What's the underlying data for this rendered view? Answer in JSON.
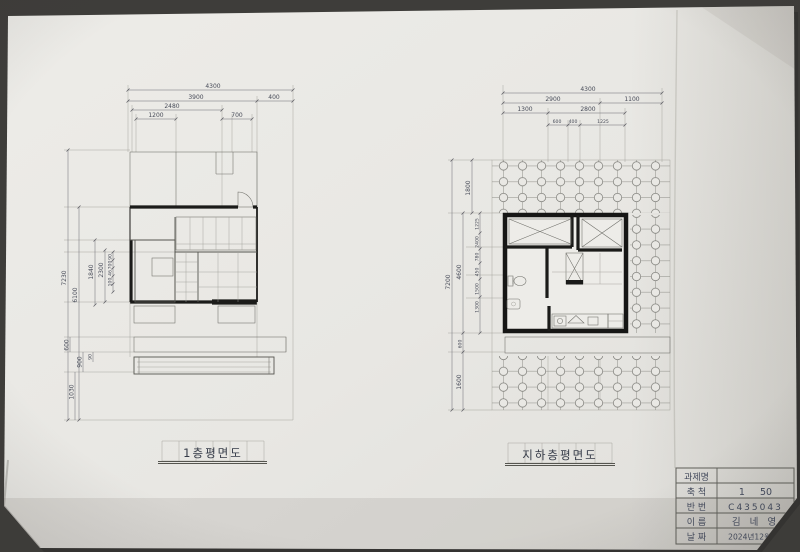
{
  "left_plan": {
    "caption": "1층평면도",
    "top_dims": [
      "4300",
      "3900",
      "400",
      "2480",
      "1200",
      "700"
    ],
    "side_dims": [
      "7230",
      "6100",
      "1840",
      "2300",
      "90",
      "700",
      "46",
      "100",
      "600",
      "900",
      "90",
      "1030"
    ]
  },
  "right_plan": {
    "caption": "지하층평면도",
    "top_dims": [
      "4300",
      "2900",
      "1100",
      "1300",
      "2800",
      "600",
      "400",
      "1225"
    ],
    "side_dims": [
      "7200",
      "4600",
      "1800",
      "1225",
      "2400",
      "780",
      "450",
      "1500",
      "1300",
      "600",
      "1600"
    ]
  },
  "title_block": {
    "rows": [
      {
        "label": "과제명",
        "value": ""
      },
      {
        "label": "축 척",
        "value": "1     50"
      },
      {
        "label": "반 번",
        "value": "C435043"
      },
      {
        "label": "이 름",
        "value": "김 네 영"
      },
      {
        "label": "날 짜",
        "value": "2024년12월7일"
      }
    ]
  }
}
